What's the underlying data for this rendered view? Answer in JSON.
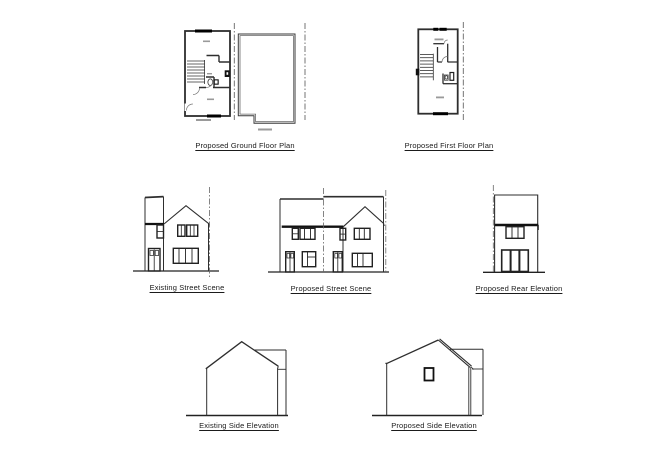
{
  "sheet": {
    "background": "#ffffff",
    "line_color": "#333333",
    "heavy_line_color": "#111111",
    "boundary_line_color": "#666666",
    "label_smudge_color": "#999999"
  },
  "drawings": {
    "proposed_ground_floor_plan": {
      "caption": "Proposed Ground Floor Plan"
    },
    "proposed_first_floor_plan": {
      "caption": "Proposed First Floor Plan"
    },
    "existing_street_scene": {
      "caption": "Existing Street Scene"
    },
    "proposed_street_scene": {
      "caption": "Proposed Street Scene"
    },
    "proposed_rear_elevation": {
      "caption": "Proposed Rear Elevation"
    },
    "existing_side_elevation": {
      "caption": "Existing Side Elevation"
    },
    "proposed_side_elevation": {
      "caption": "Proposed Side Elevation"
    }
  }
}
